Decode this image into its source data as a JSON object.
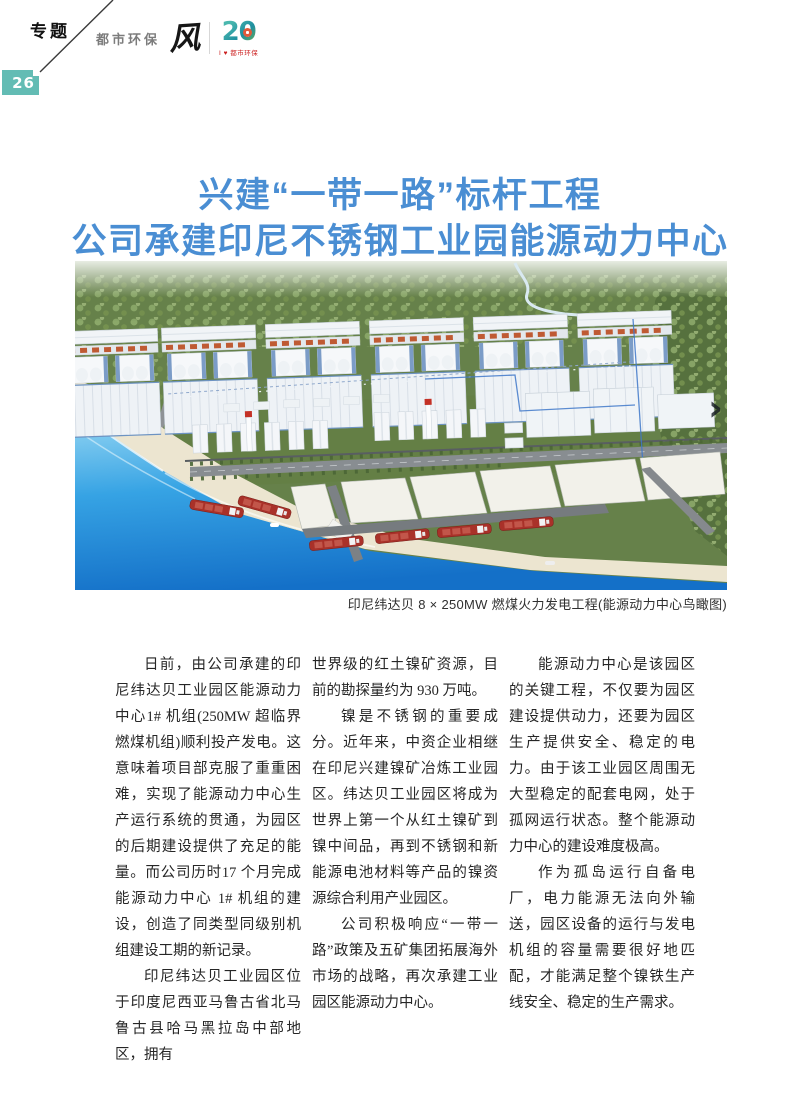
{
  "page": {
    "topic": "专题",
    "number": "26"
  },
  "brand": {
    "name": "都市环保",
    "glyph": "风",
    "anniversary_number": "20",
    "anniversary_tagline": "I ♥ 都市环保"
  },
  "title": {
    "line1": "兴建“一带一路”标杆工程",
    "line2": "公司承建印尼不锈钢工业园能源动力中心",
    "color": "#4a8ed3"
  },
  "figure": {
    "caption": "印尼纬达贝 8 × 250MW 燃煤火力发电工程(能源动力中心鸟瞰图)",
    "description": "印尼纬达贝工业园能源动力中心鸟瞰效果图",
    "next_arrow_glyph": "›"
  },
  "article": {
    "col1": [
      "日前，由公司承建的印尼纬达贝工业园区能源动力中心1# 机组(250MW 超临界燃煤机组)顺利投产发电。这意味着项目部克服了重重困难，实现了能源动力中心生产运行系统的贯通，为园区的后期建设提供了充足的能量。而公司历时17 个月完成能源动力中心 1# 机组的建设，创造了同类型同级别机组建设工期的新记录。",
      "印尼纬达贝工业园区位于印度尼西亚马鲁古省北马鲁古县哈马黑拉岛中部地区，拥有"
    ],
    "col2": [
      "世界级的红土镍矿资源，目前的勘探量约为 930 万吨。",
      "镍是不锈钢的重要成分。近年来，中资企业相继在印尼兴建镍矿冶炼工业园区。纬达贝工业园区将成为世界上第一个从红土镍矿到镍中间品，再到不锈钢和新能源电池材料等产品的镍资源综合利用产业园区。",
      "公司积极响应“一带一路”政策及五矿集团拓展海外市场的战略，再次承建工业园区能源动力中心。"
    ],
    "col3": [
      "能源动力中心是该园区的关键工程，不仅要为园区建设提供动力，还要为园区生产提供安全、稳定的电力。由于该工业园区周围无大型稳定的配套电网，处于孤网运行状态。整个能源动力中心的建设难度极高。",
      "作为孤岛运行自备电厂，电力能源无法向外输送，园区设备的运行与发电机组的容量需要很好地匹配，才能满足整个镍铁生产线安全、稳定的生产需求。"
    ]
  },
  "colors": {
    "title_blue": "#4a8ed3",
    "badge_teal": "#63bcb4",
    "tagline_red": "#cc2222",
    "sea_blue": "#1f86d6",
    "forest_green": "#66814a"
  }
}
